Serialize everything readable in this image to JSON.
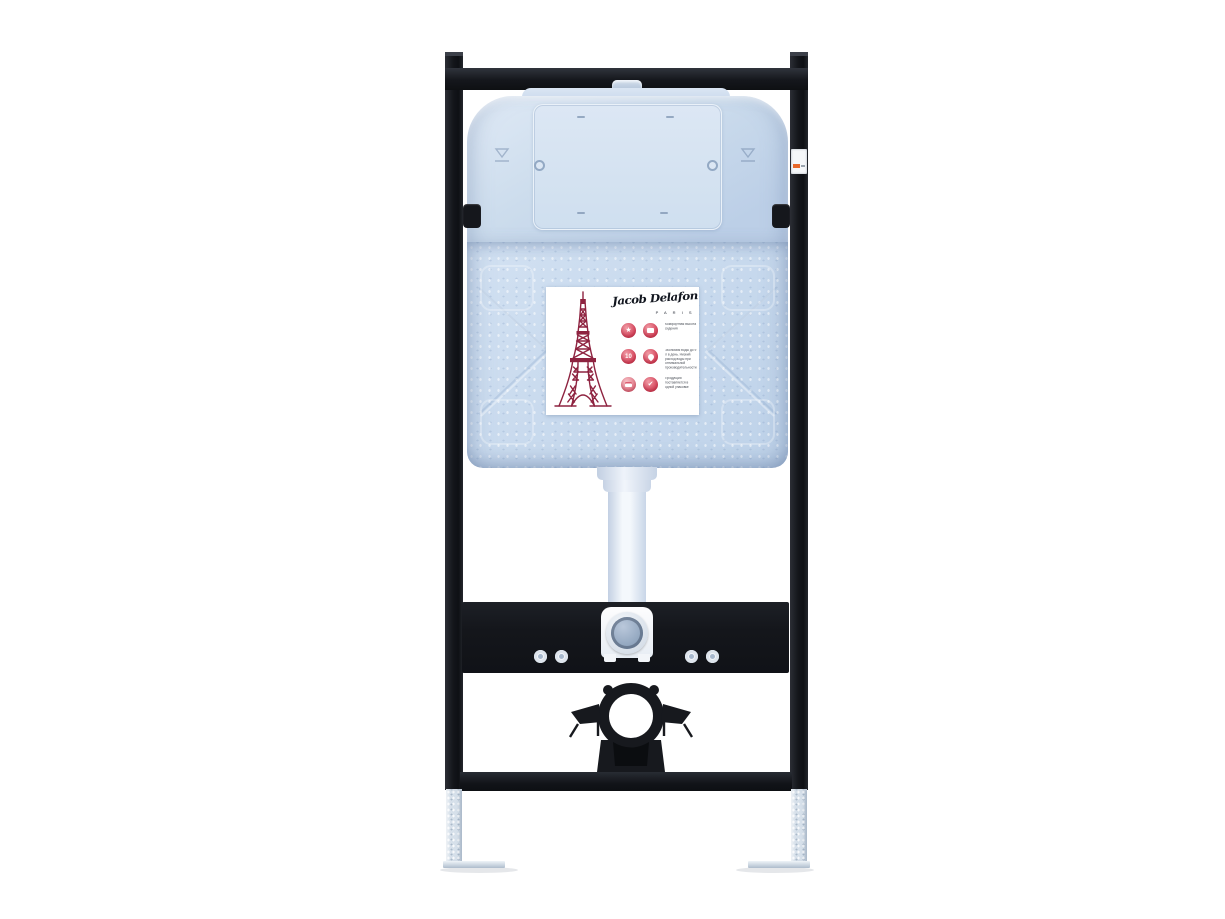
{
  "brand": {
    "signature": "Jacob Delafon",
    "city_label": "P A R I S"
  },
  "label": {
    "badge_number": "10",
    "artwork": "eiffel-tower-illustration",
    "features": [
      {
        "icons": [
          "medal-star-icon",
          "seat-height-icon"
        ],
        "text": "Комфортная высота сидения"
      },
      {
        "icons": [
          "badge-10-icon",
          "water-drop-icon"
        ],
        "text": "Экономия воды до 9 л в день. Низкий расход воды при оптимальной производительности"
      },
      {
        "icons": [
          "package-icon",
          "thumbs-up-icon"
        ],
        "text": "Продукция поставляется в одной упаковке"
      }
    ]
  },
  "hardware": {
    "frame_color": "#16181d",
    "cistern_color": "#c6d7ec",
    "access_panel_color": "#d6e2f2",
    "label_accent_color": "#d84a60",
    "tower_color": "#8e2340",
    "feet_color": "#d6e0ea",
    "sticker_accent_color": "#e8682a",
    "background_color": "#ffffff"
  }
}
